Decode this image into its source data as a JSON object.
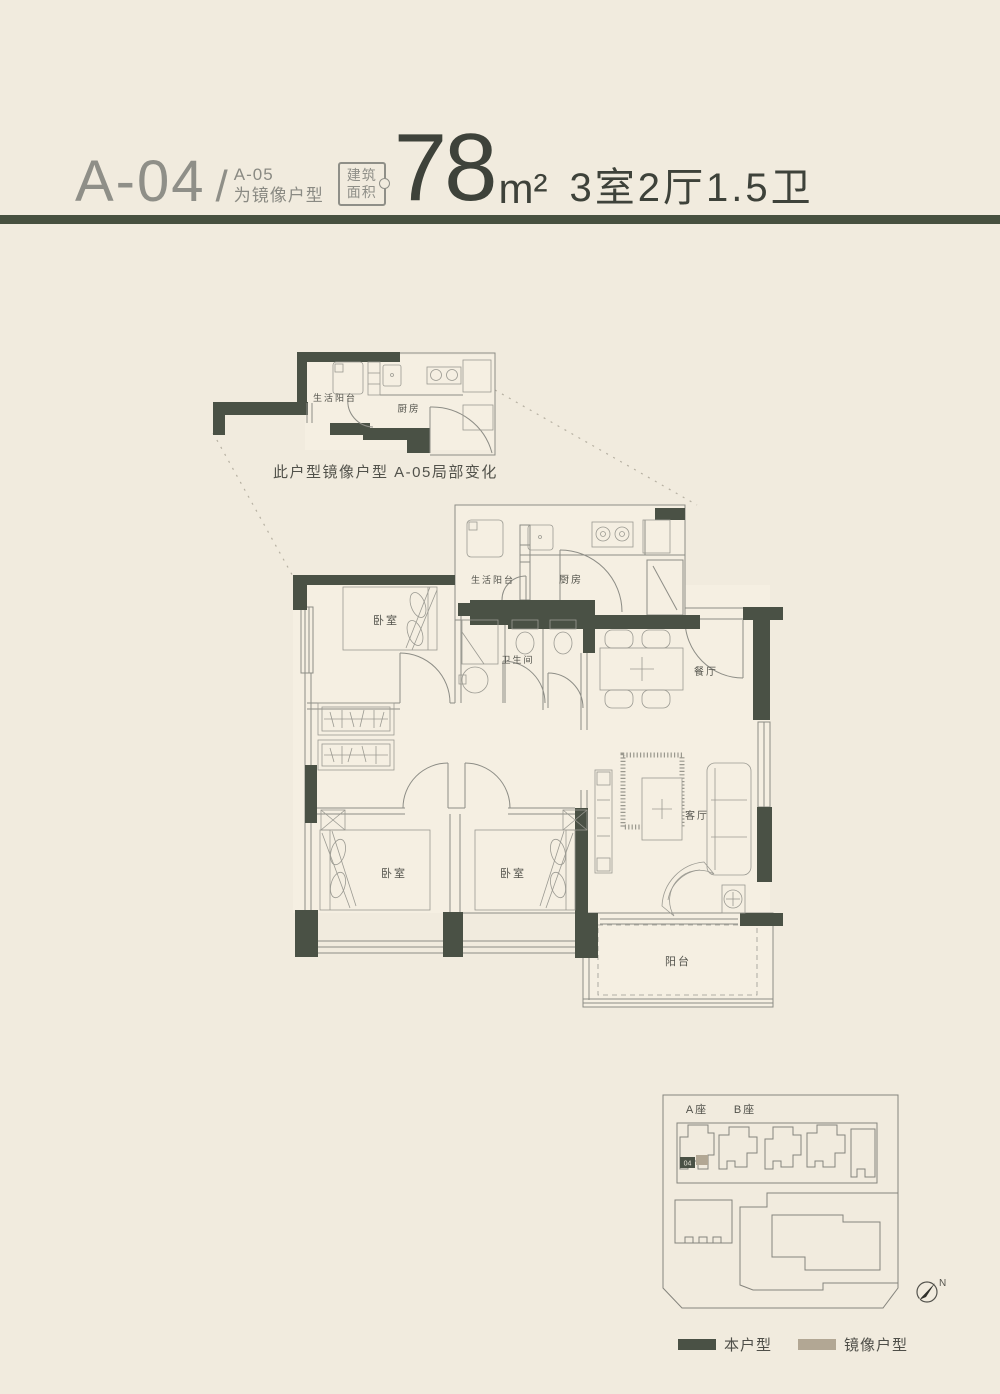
{
  "header": {
    "unit_code": "A-04",
    "separator": "/",
    "mirror_code": "A-05",
    "mirror_note": "为镜像户型",
    "area_label_line1": "建筑",
    "area_label_line2": "面积",
    "area_value": "78",
    "area_unit": "m²",
    "rooms_spec": "3室2厅1.5卫"
  },
  "detail_plan": {
    "service_balcony": "生活阳台",
    "kitchen": "厨房",
    "note": "此户型镜像户型  A-05局部变化"
  },
  "main_plan": {
    "bedroom_top": "卧室",
    "service_balcony": "生活阳台",
    "kitchen": "厨房",
    "bathroom": "卫生间",
    "dining": "餐厅",
    "living": "客厅",
    "bedroom_left": "卧室",
    "bedroom_middle": "卧室",
    "balcony": "阳台"
  },
  "site_plan": {
    "tower_a": "A座",
    "tower_b": "B座",
    "unit_marker": "04",
    "compass": "N"
  },
  "legend": {
    "this_unit": "本户型",
    "mirror_unit": "镜像户型"
  },
  "colors": {
    "background": "#f1ebde",
    "wall": "#4a5145",
    "divider_rule": "#47503f",
    "line": "#8d8d86",
    "mirror_swatch": "#b2a794",
    "text_dark": "#3e423a",
    "text_light": "#8f8f88"
  }
}
